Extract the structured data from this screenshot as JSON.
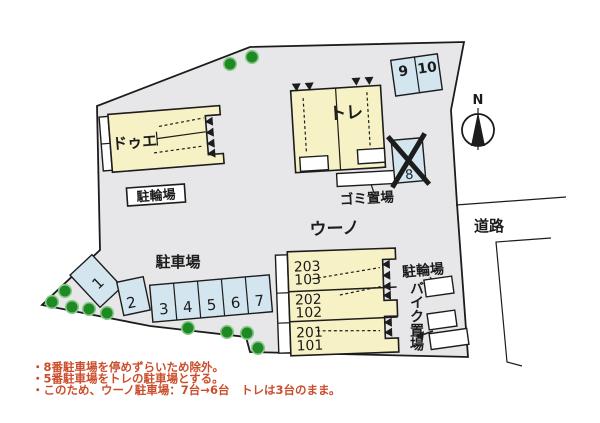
{
  "theme": {
    "line": "#1c1c1c",
    "page_bg": "#ffffff",
    "site_fill": "#e7e7e9",
    "building_fill": "#f7f2c5",
    "parking_fill": "#d3e6f0",
    "tree_fill": "#1f8a24",
    "tree_edge": "#8dc98d",
    "note_color": "#cb4e2c"
  },
  "buildings": {
    "due": {
      "label": "ドゥエ"
    },
    "tre": {
      "label": "トレ"
    },
    "uno": {
      "label": "ウーノ",
      "units": [
        "203",
        "103",
        "202",
        "102",
        "201",
        "101"
      ]
    }
  },
  "facilities": {
    "bicycle_left": "駐輪場",
    "garbage": "ゴミ置場",
    "bicycle_right": "駐輪場",
    "motorcycle": "バイク置場"
  },
  "parking": {
    "title": "駐車場",
    "spaces": [
      "1",
      "2",
      "3",
      "4",
      "5",
      "6",
      "7"
    ],
    "upper_spaces": [
      "9",
      "10"
    ],
    "excluded_space": "8"
  },
  "road_label": "道路",
  "compass_label": "N",
  "notes": [
    "・8番駐車場を停めずらいため除外。",
    "・5番駐車場をトレの駐車場とする。",
    "・このため、ウーノ駐車場：7台→6台　トレは3台のまま。"
  ]
}
